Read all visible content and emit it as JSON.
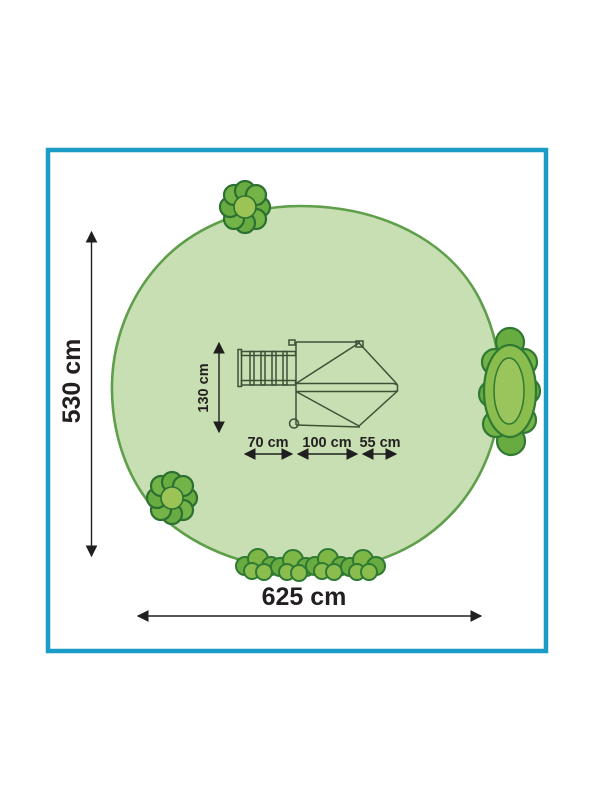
{
  "diagram": {
    "type": "playset-footprint-top-view",
    "labels": {
      "total_depth": "530 cm",
      "total_width": "625 cm",
      "structure_depth": "130 cm",
      "ladder_length": "70 cm",
      "platform_width": "100 cm",
      "roof_overhang": "55 cm"
    },
    "dimensions_cm": {
      "safety_area_width": 625,
      "safety_area_depth": 530,
      "structure_depth": 130,
      "ladder_length": 70,
      "platform_width": 100,
      "roof_overhang": 55
    },
    "colors": {
      "frame_border": "#1b9cc7",
      "area_fill": "#c7dfb2",
      "area_outline": "#5f9e4a",
      "bush_fill": "#8abc4e",
      "bush_petal": "#68ab40",
      "bush_center": "#9cc355",
      "bush_outline": "#2f7a33",
      "structure_line": "#3d5137",
      "dimension_ink": "#231f20"
    }
  }
}
